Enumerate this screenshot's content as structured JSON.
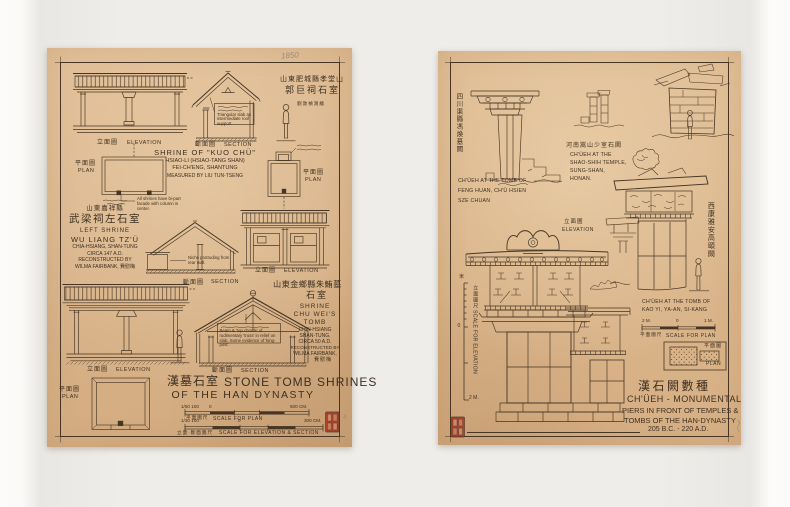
{
  "lp": {
    "pencil_year": "1850",
    "pencil_number": "4",
    "labels": {
      "elevation_cn": "立面圖",
      "elevation": "ELEVATION",
      "section_cn": "斷面圖",
      "section": "SECTION",
      "plan_cn": "平面圖",
      "plan": "PLAN"
    },
    "kuo_chu": {
      "cn_location": "山東肥城縣孝堂山",
      "cn_name": "郭巨祠石室",
      "cn_credit": "劉敦楨測繪",
      "title": "SHRINE OF \"KUO CHÜ\"",
      "subtitle1": "HSIAO-LI (HSIAO-TANG SHAN)",
      "subtitle2": "FEI-CH'ENG, SHANTUNG",
      "credit": "MEASURED BY LIU TUN-TSENG",
      "roof_note": "Triangular slab as intermediate roof support.",
      "facade_note": "All shrines have bi-part facade with column in center."
    },
    "wu_liang": {
      "cn_location": "山東嘉祥縣",
      "cn_name": "武梁祠左石室",
      "title1": "LEFT SHRINE",
      "title2": "WU LIANG TZ'Ü",
      "subtitle": "CHIA-HSIANG, SHAN-TUNG",
      "date": "CIRCA 147 A.D.",
      "credit1": "RECONSTRUCTED BY",
      "credit2": "WILMA FAIRBANK, 費慰梅",
      "niche_note": "Niche protruding from rear wall."
    },
    "chu_wei": {
      "cn_location": "山東金鄉縣朱鮪墓",
      "cn_name": "石室",
      "title1": "SHRINE",
      "title2": "CHU WEI'S",
      "title3": "TOMB",
      "subtitle1": "CHIN-HSIANG",
      "subtitle2": "SHAN-TUNG.",
      "date": "CIRCA 50 A.D.",
      "credit1": "RECONSTRUCTED BY",
      "credit2": "WILMA FAIRBANK,",
      "credit3": "費慰梅",
      "truss_note": "Beam & 'top chords' of rudimentary 'truss' in relief on slab. Some evidence of 'king-post'."
    },
    "title_cn": "漢墓石室",
    "title_en_1": "STONE TOMB SHRINES",
    "title_en_2": "OF THE HAN DYNASTY",
    "scale_plan": {
      "ratio": "1/50 100",
      "zero": "0",
      "max": "500 CM.",
      "label_cn": "平面圖尺",
      "label_en": "SCALE FOR PLAN"
    },
    "scale_elev": {
      "ratio": "1/30 100",
      "zero": "0",
      "max": "300 CM.",
      "label_cn": "立面·斷面圖尺",
      "label_en": "SCALE FOR ELEVATION & SECTION"
    }
  },
  "rp": {
    "feng_huan": {
      "cn_vertical": "四川渠縣馮煥墓闕",
      "caption1": "CH'ÜEH AT THE TOMB OF",
      "caption2": "FENG HUAN, CH'Ü HSIEN",
      "caption3": "SZE CHUAN"
    },
    "shao_shih": {
      "cn": "河南嵩山少室石闕",
      "caption1": "CH'ÜEH AT THE",
      "caption2": "SHAO-SHIH TEMPLE,",
      "caption3": "SUNG-SHAN,",
      "caption4": "HONAN."
    },
    "kao_yi": {
      "cn_vertical": "西康雅安高頤闕",
      "caption1": "CH'ÜEH AT THE TOMB OF",
      "caption2": "KAO YI, YA-AN, SI-KANG",
      "elevation_cn": "立面圖",
      "elevation": "ELEVATION",
      "plan_cn": "平面圖",
      "plan": "PLAN"
    },
    "scale_plan": {
      "left": "2 M.",
      "zero": "0",
      "right": "1 M.",
      "label_cn": "平面圖尺",
      "label_en": "SCALE FOR PLAN"
    },
    "scale_elev": {
      "top": "米",
      "zero": "0",
      "bottom": "2 M.",
      "label_cn": "立面圖尺",
      "label_en": "SCALE FOR ELEVATION"
    },
    "title_cn": "漢石闕數種",
    "title_en_1": "CH'ÜEH - MONUMENTAL",
    "title_en_2": "PIERS IN FRONT OF TEMPLES &",
    "title_en_3": "TOMBS OF THE HAN-DYNASTY",
    "title_en_4": "205 B.C. - 220 A.D."
  }
}
